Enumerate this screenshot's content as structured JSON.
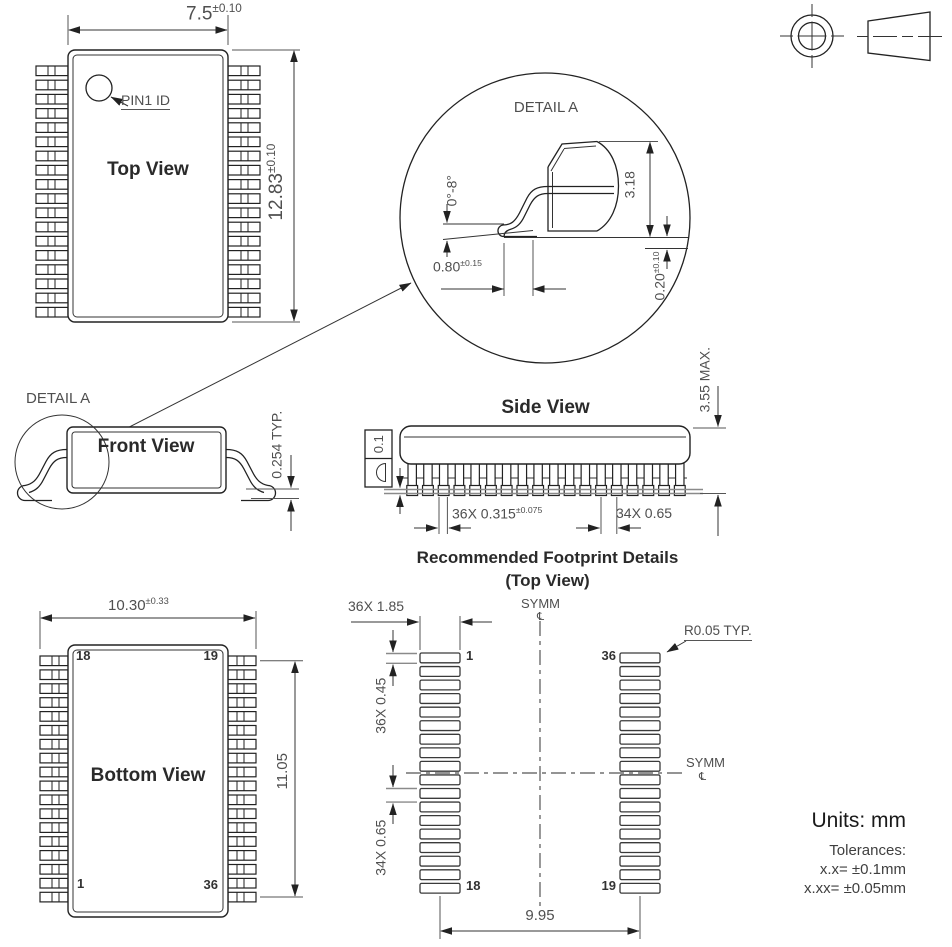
{
  "colors": {
    "line": "#222222",
    "dim_text": "#4f4f4f",
    "title_text": "#2a2a2a",
    "gray_line": "#8a8a8a"
  },
  "geometry": {
    "pins_per_side": 18,
    "pads_per_column": 18,
    "side_leads": 18
  },
  "top_view": {
    "title": "Top View",
    "pin1": "PIN1 ID",
    "width": {
      "v": "7.5",
      "t": "±0.10"
    },
    "height": {
      "v": "12.83",
      "t": "±0.10"
    }
  },
  "detail_a": {
    "label": "DETAIL A",
    "height": "3.18",
    "angle": "0°-8°",
    "foot": {
      "v": "0.80",
      "t": "±0.15"
    },
    "standoff": {
      "v": "0.20",
      "t": "±0.10"
    }
  },
  "front_view": {
    "title": "Front View",
    "detail_label": "DETAIL A",
    "lead_thickness": "0.254 TYP."
  },
  "side_view": {
    "title": "Side View",
    "max_height": "3.55 MAX.",
    "flatness": "0.1",
    "lead_width": {
      "v": "36X 0.315",
      "t": "±0.075"
    },
    "pitch": "34X 0.65"
  },
  "bottom_view": {
    "title": "Bottom View",
    "width": {
      "v": "10.30",
      "t": "±0.33"
    },
    "span": "11.05",
    "pins": {
      "top_left": "18",
      "top_right": "19",
      "bottom_left": "1",
      "bottom_right": "36"
    }
  },
  "footprint": {
    "title": "Recommended Footprint Details",
    "subtitle": "(Top View)",
    "pad_length": "36X 1.85",
    "pad_width": "36X 0.45",
    "pitch": "34X 0.65",
    "span": "9.95",
    "corner_radius": "R0.05 TYP.",
    "symm": "SYMM",
    "centerline": "℄",
    "pads": {
      "top_left": "1",
      "top_right": "36",
      "bottom_left": "18",
      "bottom_right": "19"
    }
  },
  "notes": {
    "units": "Units: mm",
    "tolerances": "Tolerances:",
    "tol1": "x.x= ±0.1mm",
    "tol2": "x.xx= ±0.05mm"
  }
}
